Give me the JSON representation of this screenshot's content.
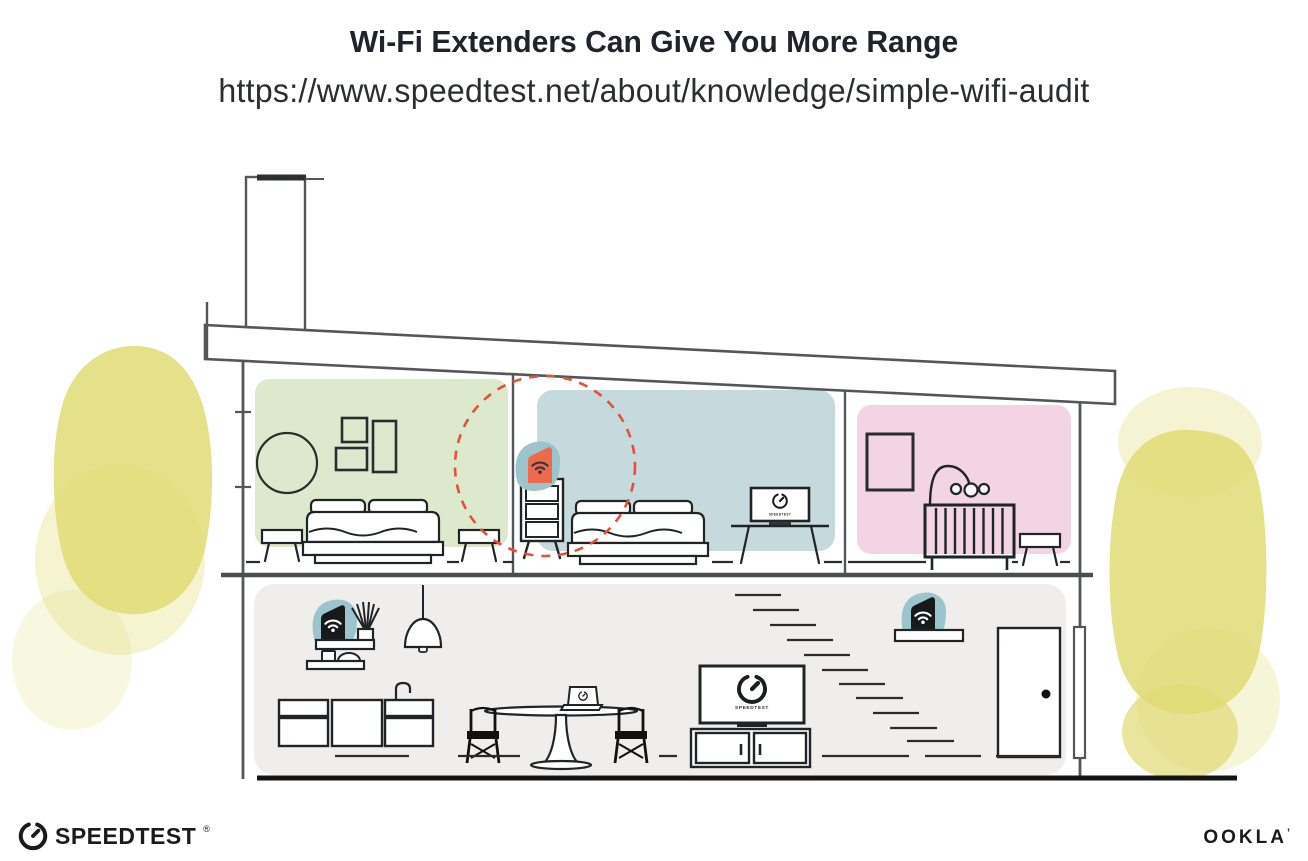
{
  "header": {
    "title": "Wi-Fi Extenders Can Give You More Range",
    "url": "https://www.speedtest.net/about/knowledge/simple-wifi-audit"
  },
  "illustration": {
    "bedroom_tv_label": "SPEEDTEST",
    "living_tv_label": "SPEEDTEST",
    "colors": {
      "room_green": "#dde9cd",
      "room_blue": "#c6dade",
      "room_pink": "#f3d4e5",
      "lower_floor_gray": "#f0eeec",
      "device_halo_teal": "#9cc4cc",
      "extender_orange": "#ee6a4c",
      "coverage_circle_red": "#e0523c",
      "foliage_yellow": "#e0da76",
      "line_gray": "#54565a",
      "ink_black": "#212426"
    }
  },
  "footer": {
    "speedtest_wordmark": "SPEEDTEST",
    "registered_mark": "®",
    "ookla_wordmark": "OOKLA",
    "trademark_tick": "’"
  }
}
